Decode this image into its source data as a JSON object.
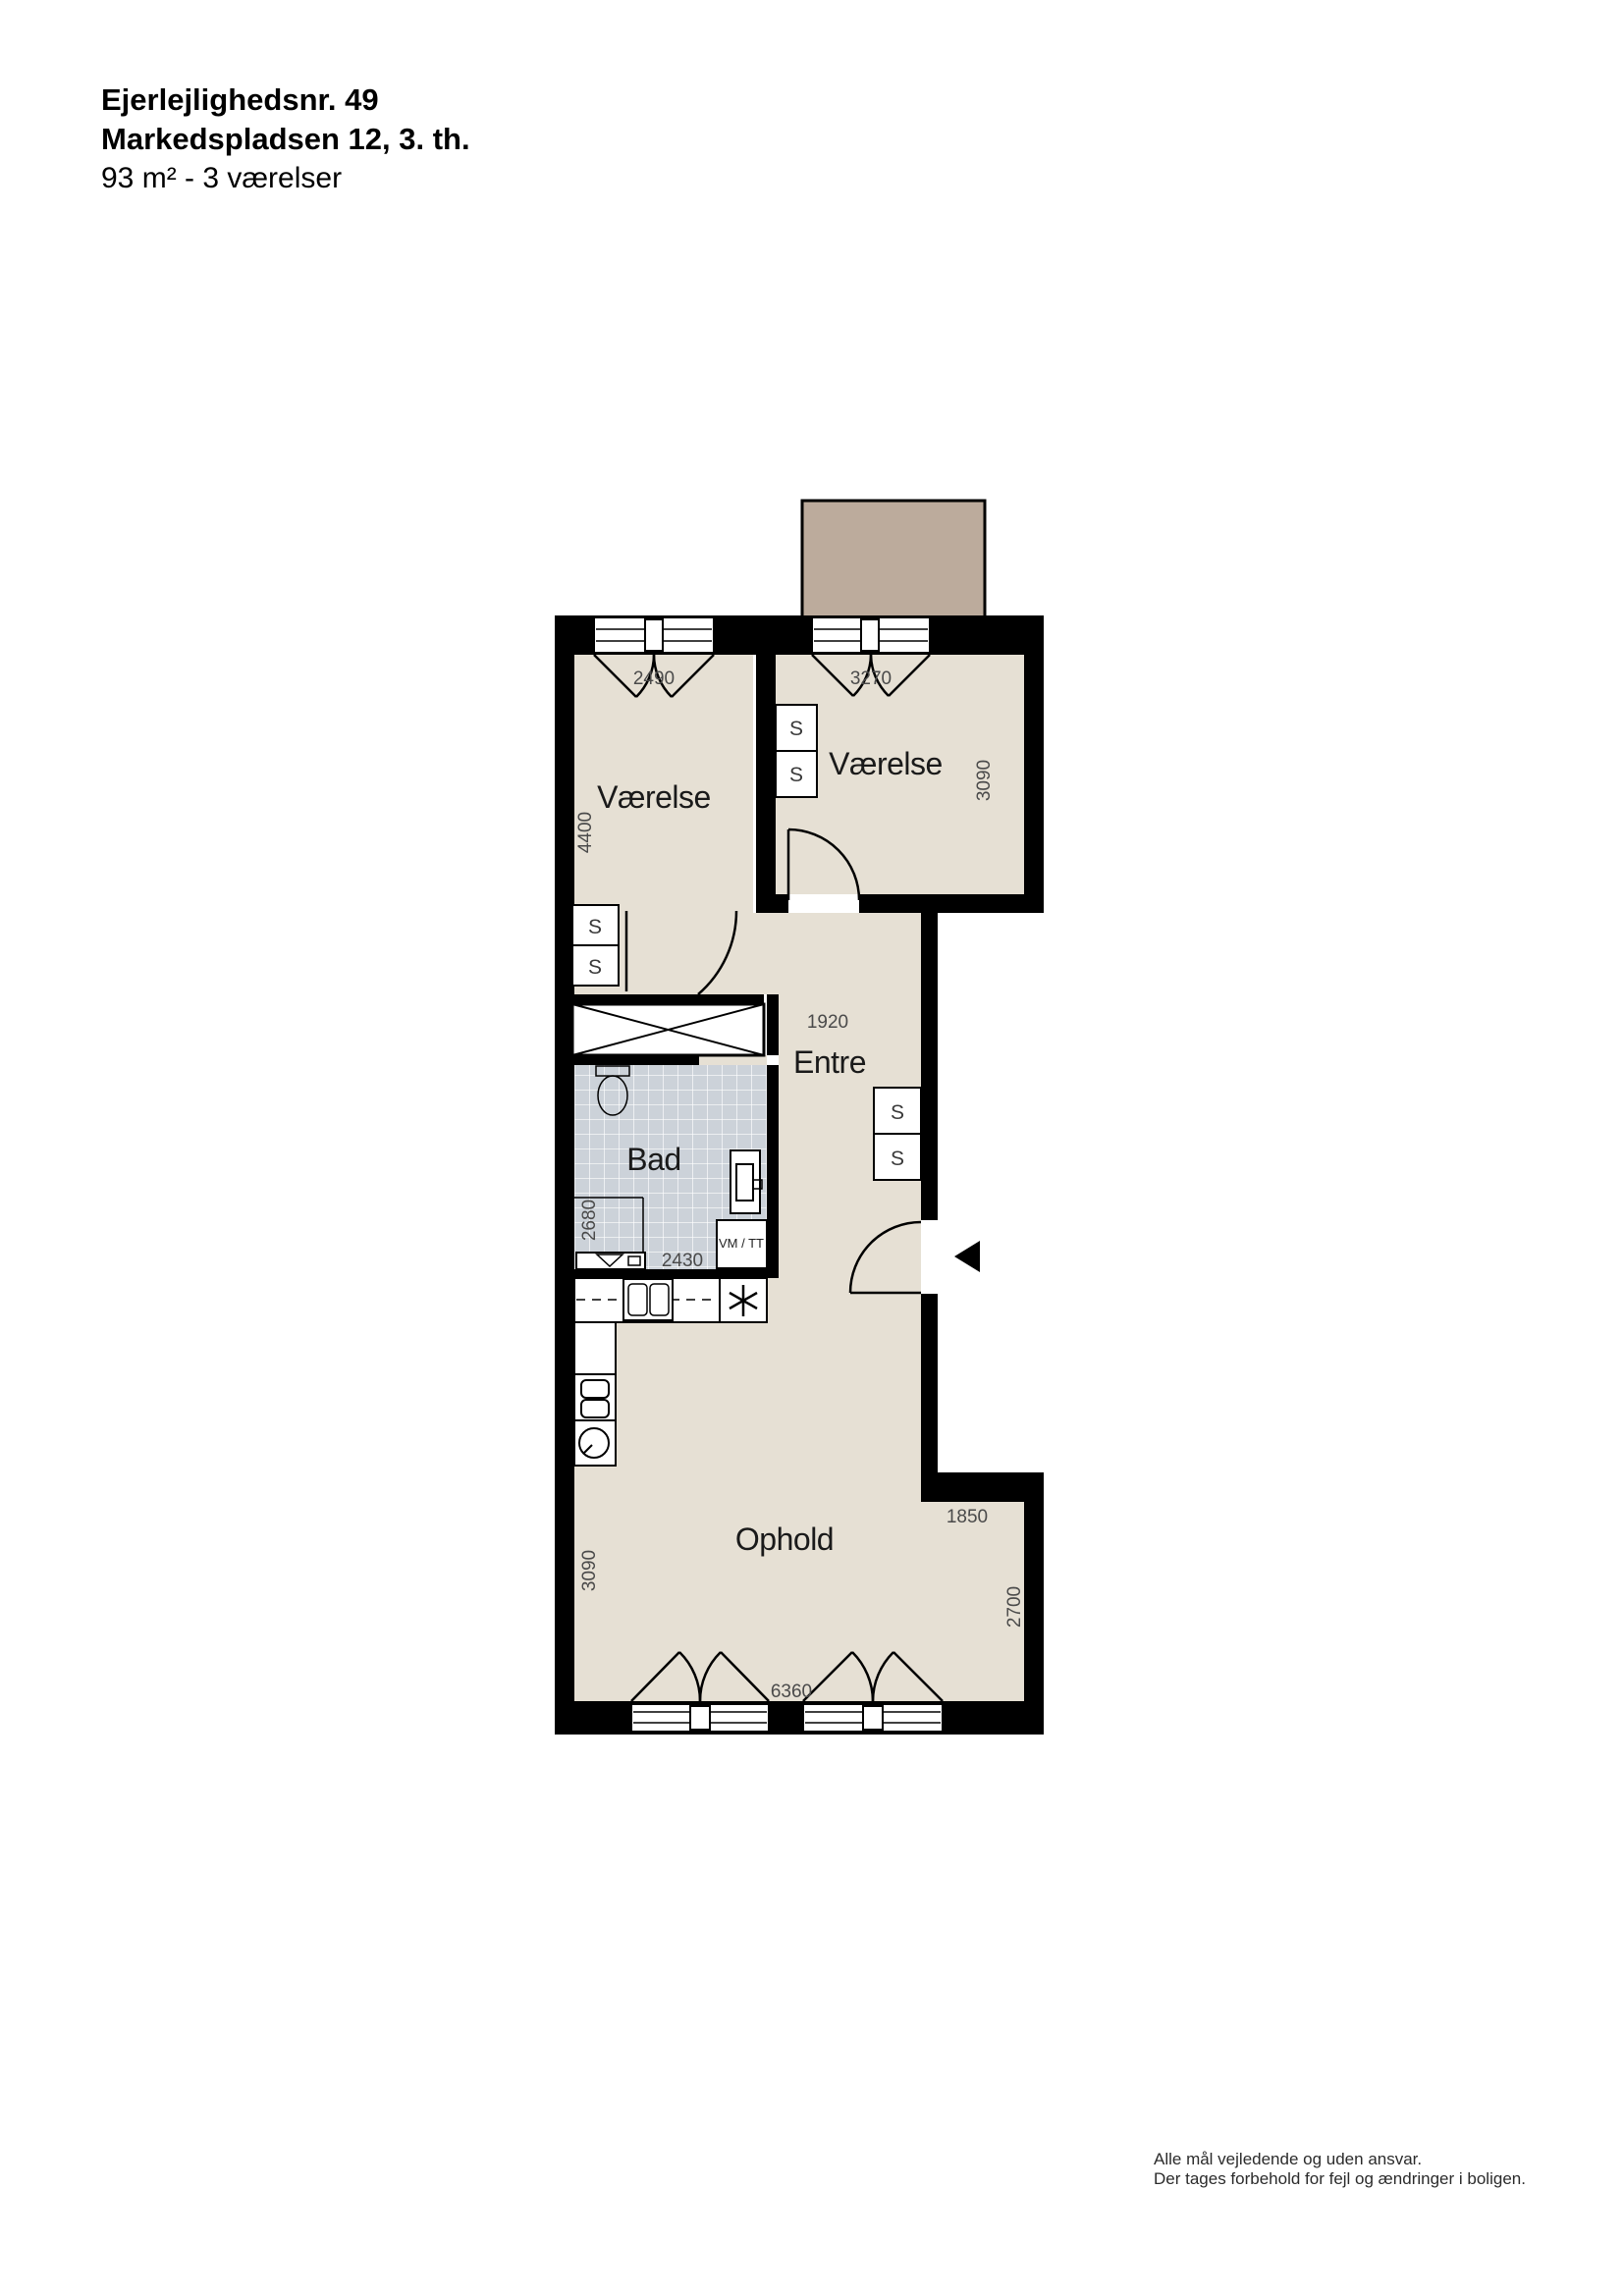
{
  "header": {
    "line1": "Ejerlejlighedsnr. 49",
    "line2": "Markedspladsen 12, 3. th.",
    "line3": "93 m² - 3 værelser"
  },
  "plan": {
    "rooms": {
      "vaerelse1": {
        "label": "Værelse",
        "width": "2490",
        "depth": "4400"
      },
      "vaerelse2": {
        "label": "Værelse",
        "width": "3270",
        "depth": "3090"
      },
      "entre": {
        "label": "Entre",
        "width": "1920"
      },
      "bad": {
        "label": "Bad",
        "depth": "2680",
        "width": "2430"
      },
      "ophold": {
        "label": "Ophold",
        "width": "6360",
        "depth": "3090",
        "alcove_width": "1850",
        "alcove_depth": "2700"
      }
    },
    "closets": [
      {
        "label": "S"
      },
      {
        "label": "S"
      },
      {
        "label": "S"
      },
      {
        "label": "S"
      },
      {
        "label": "S"
      },
      {
        "label": "S"
      }
    ],
    "appliances": {
      "washer_dryer": "VM / TT"
    }
  },
  "footer": {
    "line1": "Alle mål vejledende og uden ansvar.",
    "line2": "Der tages forbehold for fejl og ændringer i boligen."
  },
  "colors": {
    "floor": "#e6e0d4",
    "balcony": "#bcab9c",
    "tile": "#ccd2d9",
    "wall": "#000000",
    "dim": "#4a4a4a",
    "label": "#1a1a1a"
  }
}
